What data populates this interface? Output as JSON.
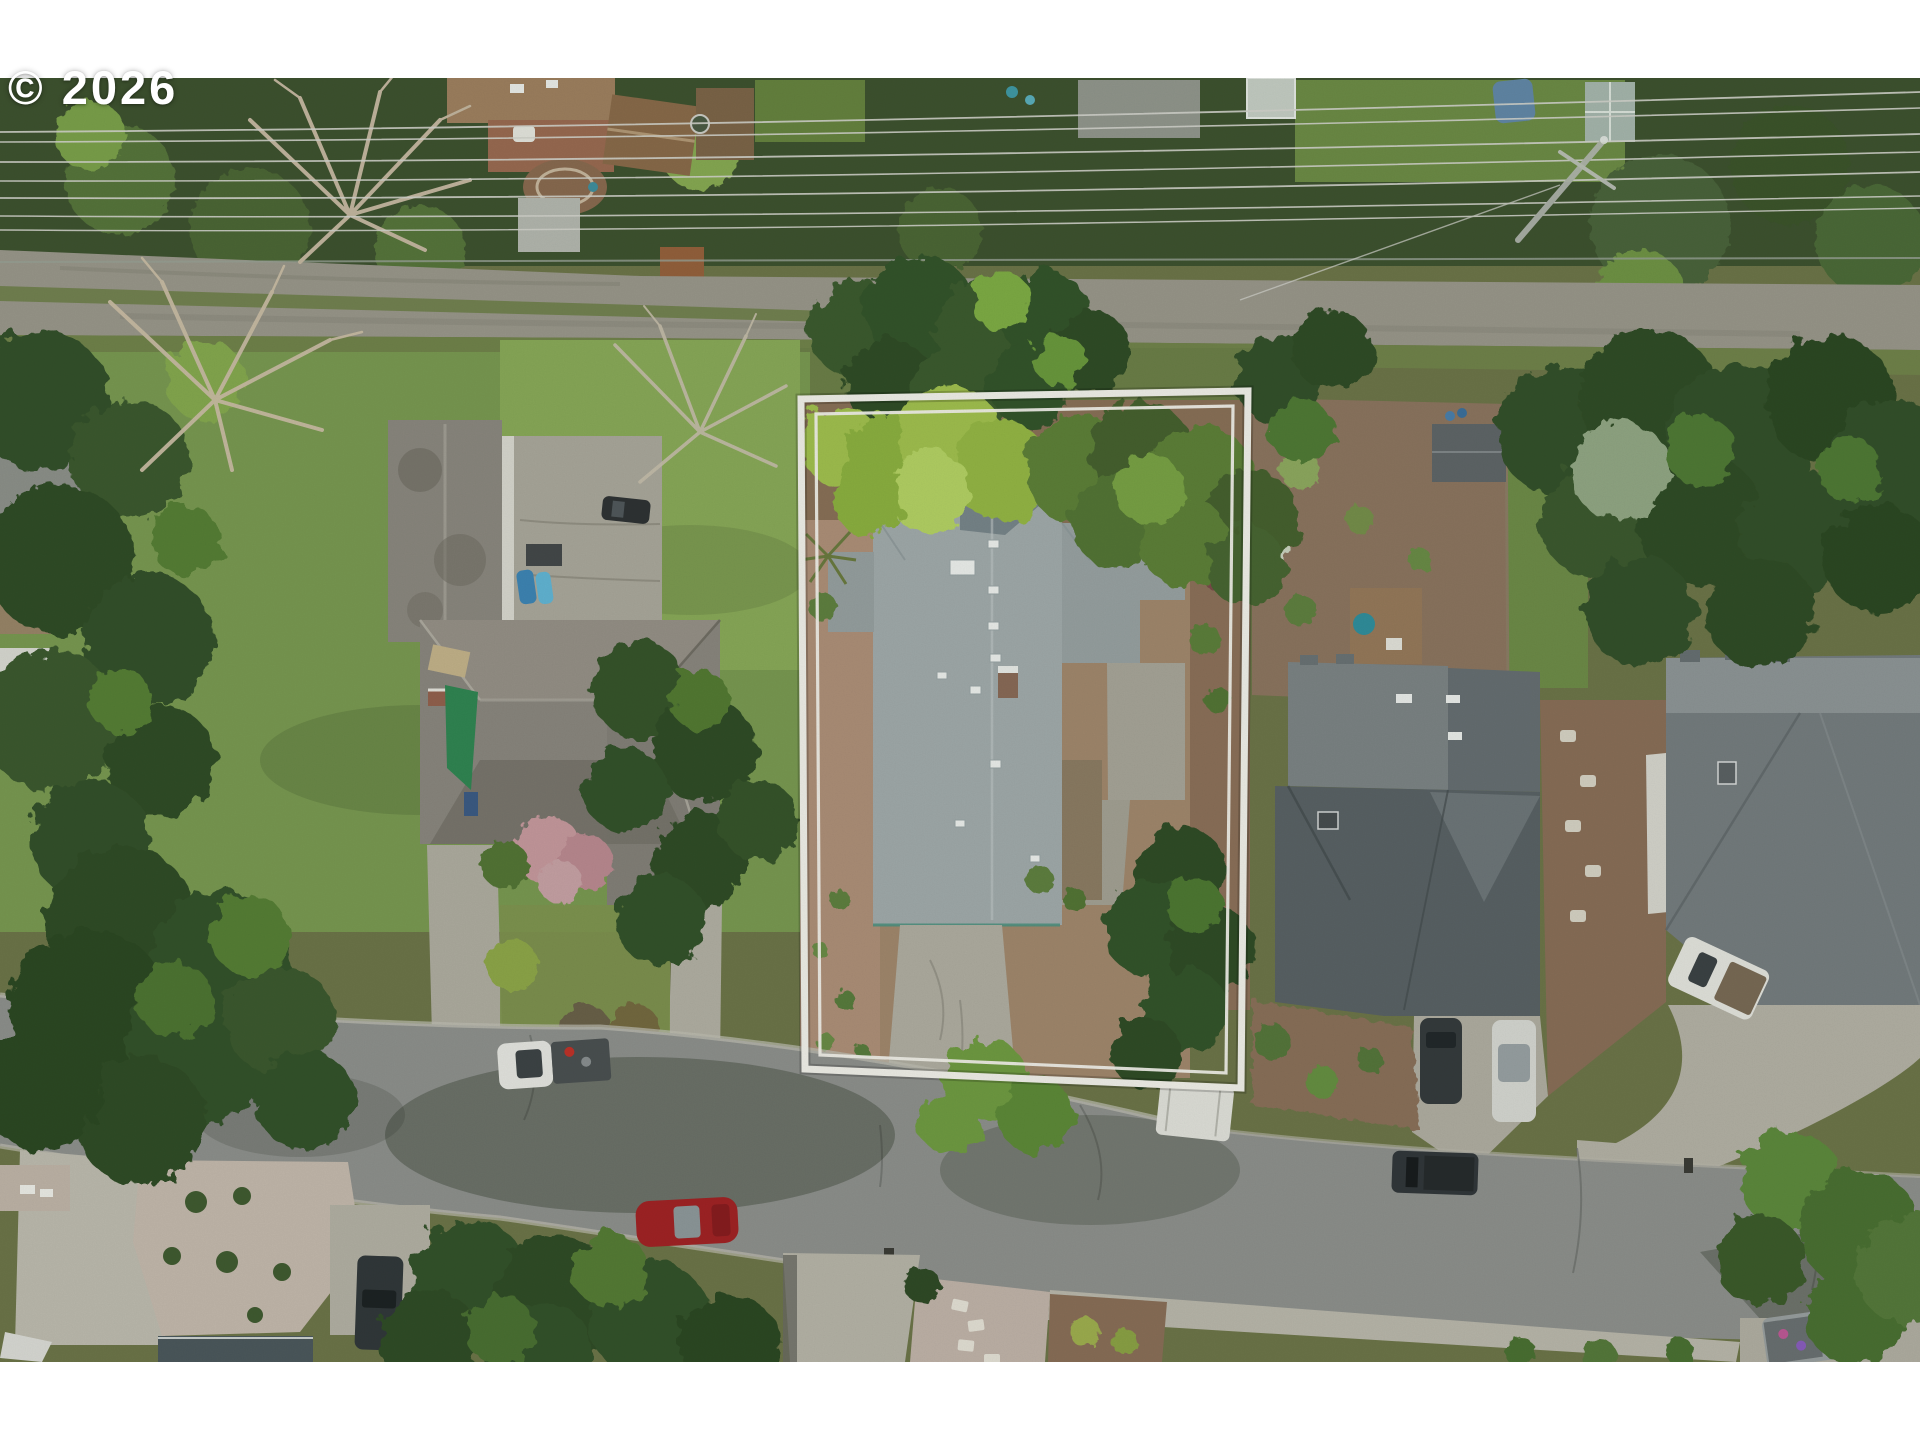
{
  "image": {
    "kind": "aerial-drone-photograph",
    "subject": "residential neighborhood lot with white property boundary outline",
    "width_px": 1920,
    "height_px": 1440,
    "letterbox": "white bands above and below photo"
  },
  "watermark": {
    "text": "© 2026"
  },
  "property_outline": {
    "style": "double white line",
    "color": "#f5f3ee",
    "shape": "tall rectangle, slightly tilted"
  },
  "palette": {
    "page-bg": "#ffffff",
    "canopy-dark": "#3d512f",
    "canopy-mid": "#55703a",
    "canopy-bright": "#7fa74b",
    "canopy-lime": "#a9c75d",
    "lawn": "#7a9a52",
    "lawn-bright": "#8aab59",
    "grass-dull": "#71834b",
    "asphalt": "#8f918f",
    "concrete": "#b9b6ab",
    "concrete-bright": "#c7c4b9",
    "gravel-alley": "#9b988d",
    "mulch": "#8a7058",
    "mulch-light": "#b0907a",
    "stone-gravel": "#c7bbb0",
    "roof-subject": "#a3acae",
    "roof-subject-light": "#bcc4c6",
    "roof-left": "#8b8780",
    "roof-right": "#596166",
    "roof-right-light": "#7d8487",
    "roof-farright": "#767d81",
    "roof-bottom": "#4b575d",
    "outline-white": "#f5f3ee",
    "watermark": "#ffffff",
    "bare-branch": "#c6b8a2",
    "powerline": "#d6d6d1",
    "shadow": "#1e2817",
    "tarp-green": "#2f8653",
    "car-red": "#a32024",
    "vehicle-white": "#e9e9e5",
    "vehicle-dark": "#30353a",
    "kayak-blue": "#3d85b8"
  },
  "scene": {
    "roads": [
      {
        "name": "gravel-back-alley",
        "position": "upper band",
        "surface": "gravel with grass strip"
      },
      {
        "name": "asphalt-street",
        "position": "lower band, slight diagonal",
        "surface": "asphalt with tree shadows"
      }
    ],
    "power_lines": {
      "count": 7,
      "direction": "horizontal across top",
      "pole": "leaning utility pole right of center"
    },
    "houses": [
      {
        "name": "subject-house",
        "roof_color": "light blue-gray shingle",
        "location": "inside white outline"
      },
      {
        "name": "left-neighbor-house",
        "roof_color": "weathered gray",
        "features": [
          "courtyard",
          "green tarp",
          "kayaks"
        ]
      },
      {
        "name": "right-neighbor-house",
        "roof_color": "dark slate gray",
        "features": [
          "rear deck",
          "hot tub",
          "shed"
        ]
      },
      {
        "name": "far-right-house",
        "roof_color": "medium gray",
        "features": [
          "curved driveway"
        ]
      },
      {
        "name": "bottom-edge-house",
        "roof_color": "dark blue-gray"
      },
      {
        "name": "top-edge-house",
        "roof_color": "tan-brown",
        "features": [
          "deck",
          "hot tub",
          "garden",
          "rust shed"
        ]
      }
    ],
    "vehicles": [
      {
        "name": "white-pickup-street",
        "color": "#e9e9e5"
      },
      {
        "name": "red-car-street",
        "color": "#a32024"
      },
      {
        "name": "white-camper-street",
        "color": "#e4e4df"
      },
      {
        "name": "dark-pickup-street-right",
        "color": "#30353a"
      },
      {
        "name": "dark-suv-right-driveway",
        "color": "#34393d"
      },
      {
        "name": "white-sedan-right-driveway",
        "color": "#d9dad6"
      },
      {
        "name": "white-pickup-far-right-driveway",
        "color": "#e7e7e2"
      },
      {
        "name": "dark-truck-bottom-left",
        "color": "#30363a"
      },
      {
        "name": "gray-truck-bottom-right",
        "color": "#9aa0a2"
      },
      {
        "name": "dark-suv-courtyard",
        "color": "#2d3134"
      },
      {
        "name": "blue-kayaks",
        "color": "#3d85b8"
      }
    ],
    "vegetation": [
      "dark conifers",
      "bare winter trees",
      "bright lime maple",
      "pink blossom shrub",
      "bark mulch beds",
      "gravel rock gardens"
    ]
  }
}
